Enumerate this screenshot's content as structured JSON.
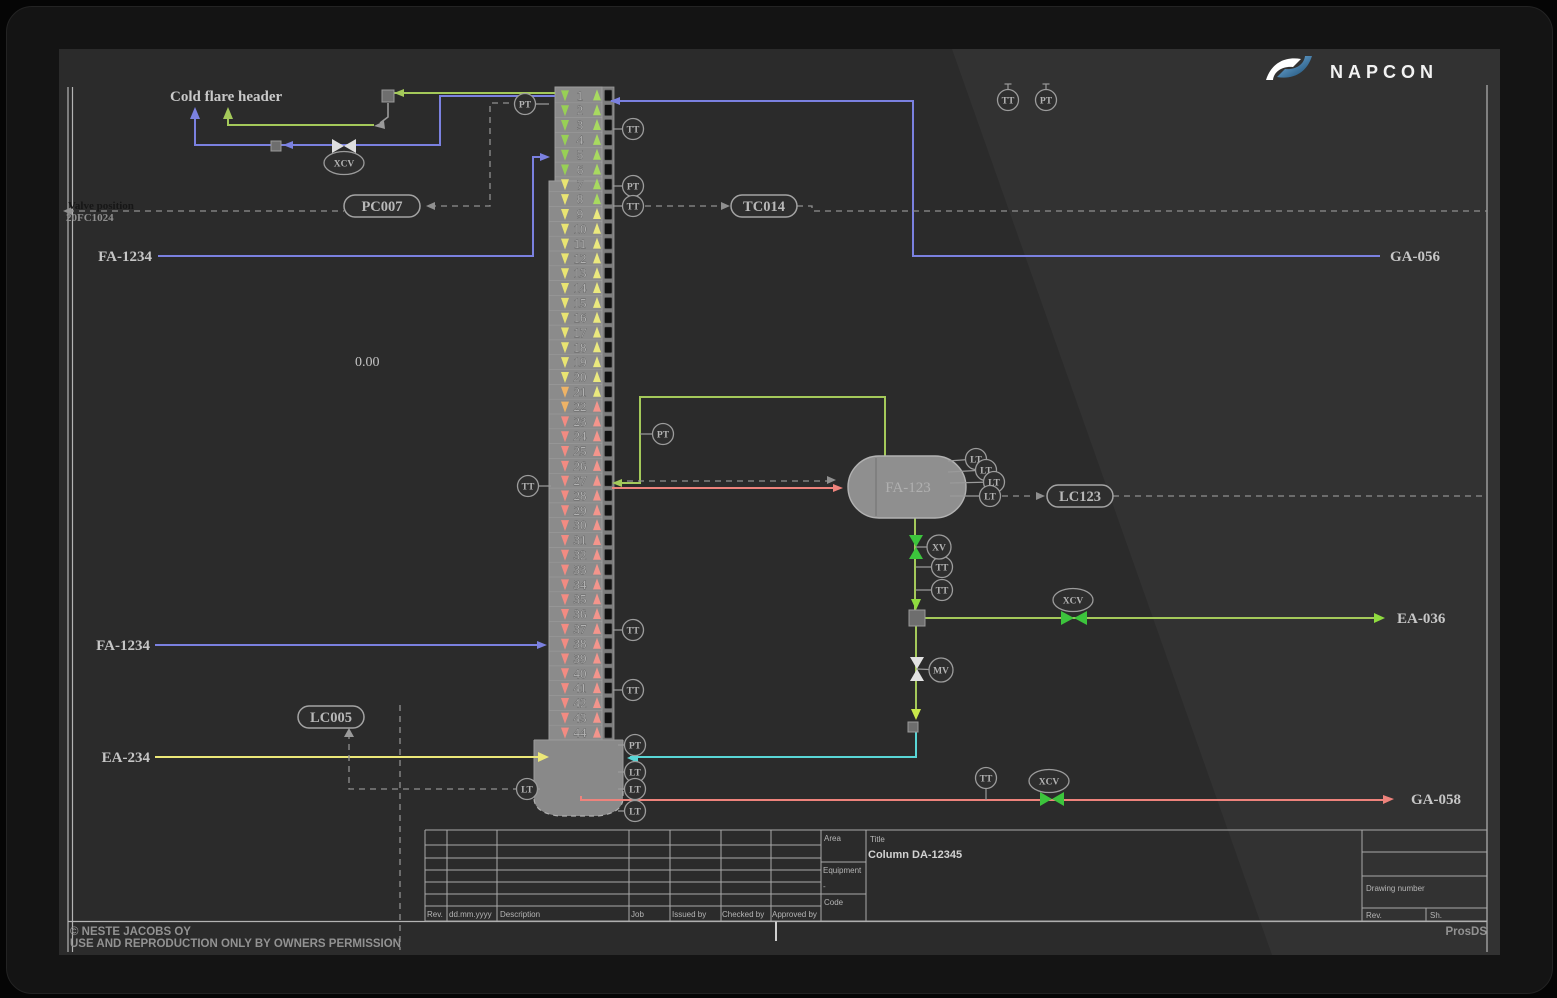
{
  "brand": {
    "name": "NAPCON"
  },
  "colors": {
    "blue": "#7b81e0",
    "green": "#a4c95a",
    "bright_green": "#3cc43c",
    "yellow": "#ece878",
    "cyan": "#59d6d6",
    "red": "#ee837c",
    "gray": "#9a9a9a",
    "screen_bg": "#2b2b2b"
  },
  "annotations": {
    "cold_flare_header": "Cold flare header",
    "valve_position": "Valve position",
    "valve_position_tag": "20FC1024",
    "readout_value": "0.00"
  },
  "streams": {
    "fa1234_top": "FA-1234",
    "fa1234_mid": "FA-1234",
    "ea234": "EA-234",
    "ga056": "GA-056",
    "ea036": "EA-036",
    "ga058": "GA-058"
  },
  "equipment": {
    "drum_label": "FA-123"
  },
  "column": {
    "tray_count": 44,
    "down_arrow_colors": [
      {
        "until": 6,
        "color": "#98d055"
      },
      {
        "until": 20,
        "color": "#e9e472"
      },
      {
        "until": 22,
        "color": "#eeb366"
      },
      {
        "until": 44,
        "color": "#f28b82"
      }
    ],
    "up_arrow_colors": [
      {
        "until": 8,
        "color": "#a8da60"
      },
      {
        "until": 21,
        "color": "#ebe97e"
      },
      {
        "until": 44,
        "color": "#f4958c"
      }
    ]
  },
  "controllers": [
    {
      "x": 382,
      "y": 206,
      "w": 76,
      "label": "PC007"
    },
    {
      "x": 764,
      "y": 206,
      "w": 66,
      "label": "TC014"
    },
    {
      "x": 1080,
      "y": 496,
      "w": 66,
      "label": "LC123"
    },
    {
      "x": 331,
      "y": 717,
      "w": 66,
      "label": "LC005"
    }
  ],
  "instruments": [
    {
      "x": 525,
      "y": 104,
      "label": "PT",
      "stub": [
        549,
        104
      ]
    },
    {
      "x": 633,
      "y": 129,
      "label": "TT",
      "stub": [
        613,
        129
      ]
    },
    {
      "x": 633,
      "y": 186,
      "label": "PT",
      "stub": [
        613,
        186
      ]
    },
    {
      "x": 633,
      "y": 206,
      "label": "TT",
      "stub": [
        613,
        206
      ]
    },
    {
      "x": 1008,
      "y": 100,
      "label": "TT",
      "hat": true
    },
    {
      "x": 1046,
      "y": 100,
      "label": "PT",
      "hat": true
    },
    {
      "x": 663,
      "y": 434,
      "label": "PT",
      "stub": [
        640,
        434
      ]
    },
    {
      "x": 528,
      "y": 486,
      "label": "TT",
      "stub": [
        551,
        486
      ]
    },
    {
      "x": 633,
      "y": 630,
      "label": "TT",
      "stub": [
        613,
        630
      ]
    },
    {
      "x": 633,
      "y": 690,
      "label": "TT",
      "stub": [
        613,
        690
      ]
    },
    {
      "x": 635,
      "y": 745,
      "label": "PT",
      "stub": [
        618,
        745
      ]
    },
    {
      "x": 635,
      "y": 772,
      "label": "LT",
      "stub": [
        618,
        772
      ]
    },
    {
      "x": 635,
      "y": 789,
      "label": "LT",
      "stub": [
        618,
        789
      ]
    },
    {
      "x": 635,
      "y": 811,
      "label": "LT",
      "stub": [
        618,
        811
      ]
    },
    {
      "x": 527,
      "y": 789,
      "label": "LT",
      "stub": [
        540,
        789
      ]
    },
    {
      "x": 976,
      "y": 459,
      "label": "LT",
      "stub": [
        948,
        461
      ]
    },
    {
      "x": 986,
      "y": 470,
      "label": "LT",
      "stub": [
        948,
        472
      ]
    },
    {
      "x": 994,
      "y": 482,
      "label": "LT",
      "stub": [
        950,
        483
      ]
    },
    {
      "x": 990,
      "y": 496,
      "label": "LT",
      "stub": [
        950,
        496
      ]
    },
    {
      "x": 942,
      "y": 567,
      "label": "TT",
      "stub": [
        916,
        567
      ]
    },
    {
      "x": 942,
      "y": 590,
      "label": "TT",
      "stub": [
        916,
        590
      ]
    },
    {
      "x": 986,
      "y": 778,
      "label": "TT",
      "stub": [
        986,
        800
      ]
    }
  ],
  "valve_tags": [
    {
      "x": 344,
      "y": 163,
      "label": "XCV",
      "shape": "ellipse"
    },
    {
      "x": 939,
      "y": 547,
      "label": "XV",
      "shape": "circle",
      "stub": [
        916,
        547
      ]
    },
    {
      "x": 1073,
      "y": 600,
      "label": "XCV",
      "shape": "ellipse"
    },
    {
      "x": 941,
      "y": 670,
      "label": "MV",
      "shape": "circle",
      "stub": [
        917,
        669
      ]
    },
    {
      "x": 1049,
      "y": 781,
      "label": "XCV",
      "shape": "ellipse"
    }
  ],
  "title_block": {
    "area_label": "Area",
    "title_label": "Title",
    "title_value": "Column DA-12345",
    "equipment_label": "Equipment",
    "equipment_value": "-",
    "code_label": "Code",
    "drawing_number_label": "Drawing number",
    "rev_label": "Rev.",
    "sheet_label": "Sh.",
    "rev_headers": [
      "Rev.",
      "dd.mm.yyyy",
      "Description",
      "Job",
      "Issued by",
      "Checked by",
      "Approved by"
    ]
  },
  "footer": {
    "copyright_1": "© NESTE JACOBS OY",
    "copyright_2": "USE AND REPRODUCTION ONLY BY OWNERS PERMISSION",
    "system_name": "ProsDS"
  }
}
